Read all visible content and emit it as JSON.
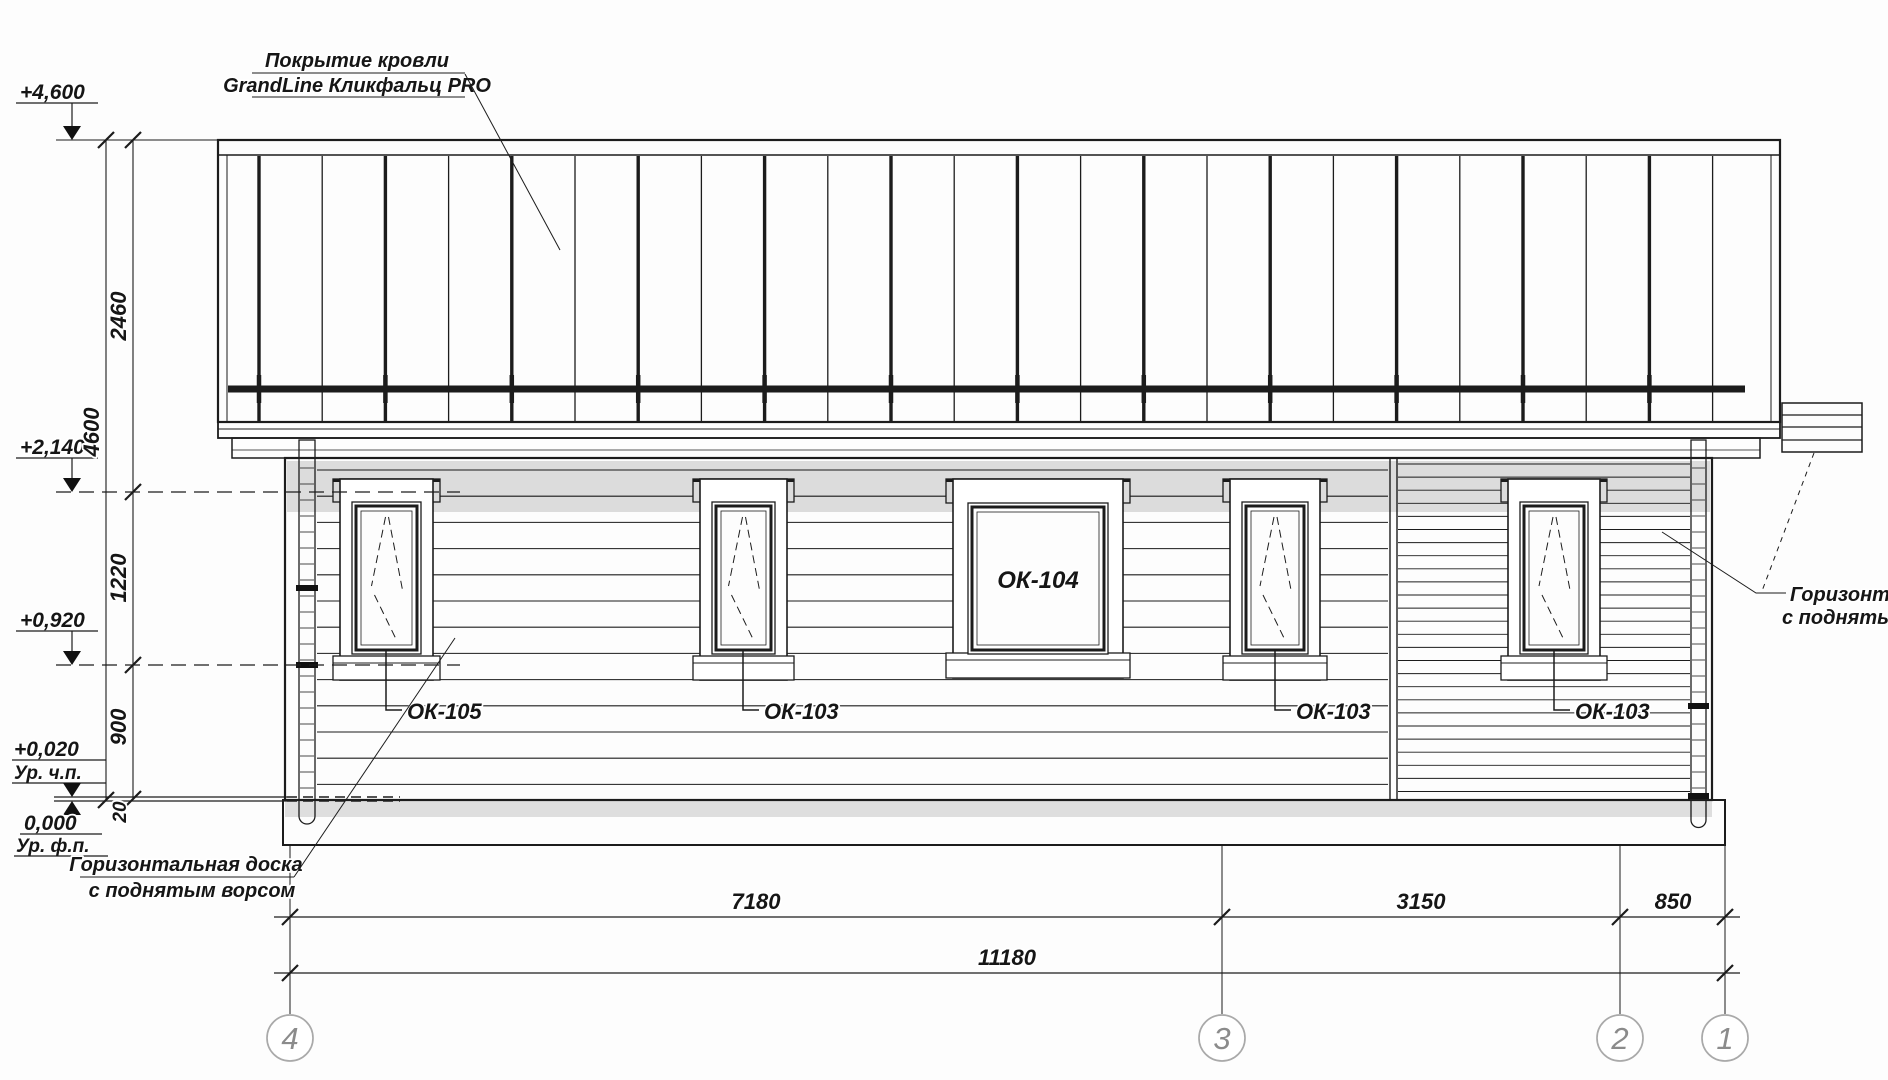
{
  "drawing": {
    "roof_note": {
      "line1": "Покрытие кровли",
      "line2": "GrandLine Кликфальц PRO"
    },
    "elevation_marks": {
      "top": {
        "value": "+4,600"
      },
      "eaves": {
        "value": "+2,140"
      },
      "window_sill": {
        "value": "+0,920"
      },
      "floor": {
        "value": "+0,020",
        "label": "Ур. ч.п."
      },
      "foundation": {
        "value": "0,000",
        "label": "Ур. ф.п."
      }
    },
    "vertical_dims": {
      "roof": "2460",
      "total": "4600",
      "window_band": "1220",
      "plinth": "900",
      "gap": "20"
    },
    "horizontal_dims": {
      "span_4_3": "7180",
      "span_3_2": "3150",
      "span_2_1": "850",
      "total": "11180"
    },
    "windows": {
      "w1": "ОК-105",
      "w2": "ОК-103",
      "w3": "ОК-104",
      "w4": "ОК-103",
      "w5": "ОК-103"
    },
    "board_note_left": {
      "line1": "Горизонтальная доска",
      "line2": "с поднятым ворсом"
    },
    "board_note_right": {
      "line1": "Горизонтал",
      "line2": "с поднятым"
    },
    "axes": {
      "a4": "4",
      "a3": "3",
      "a2": "2",
      "a1": "1"
    }
  }
}
